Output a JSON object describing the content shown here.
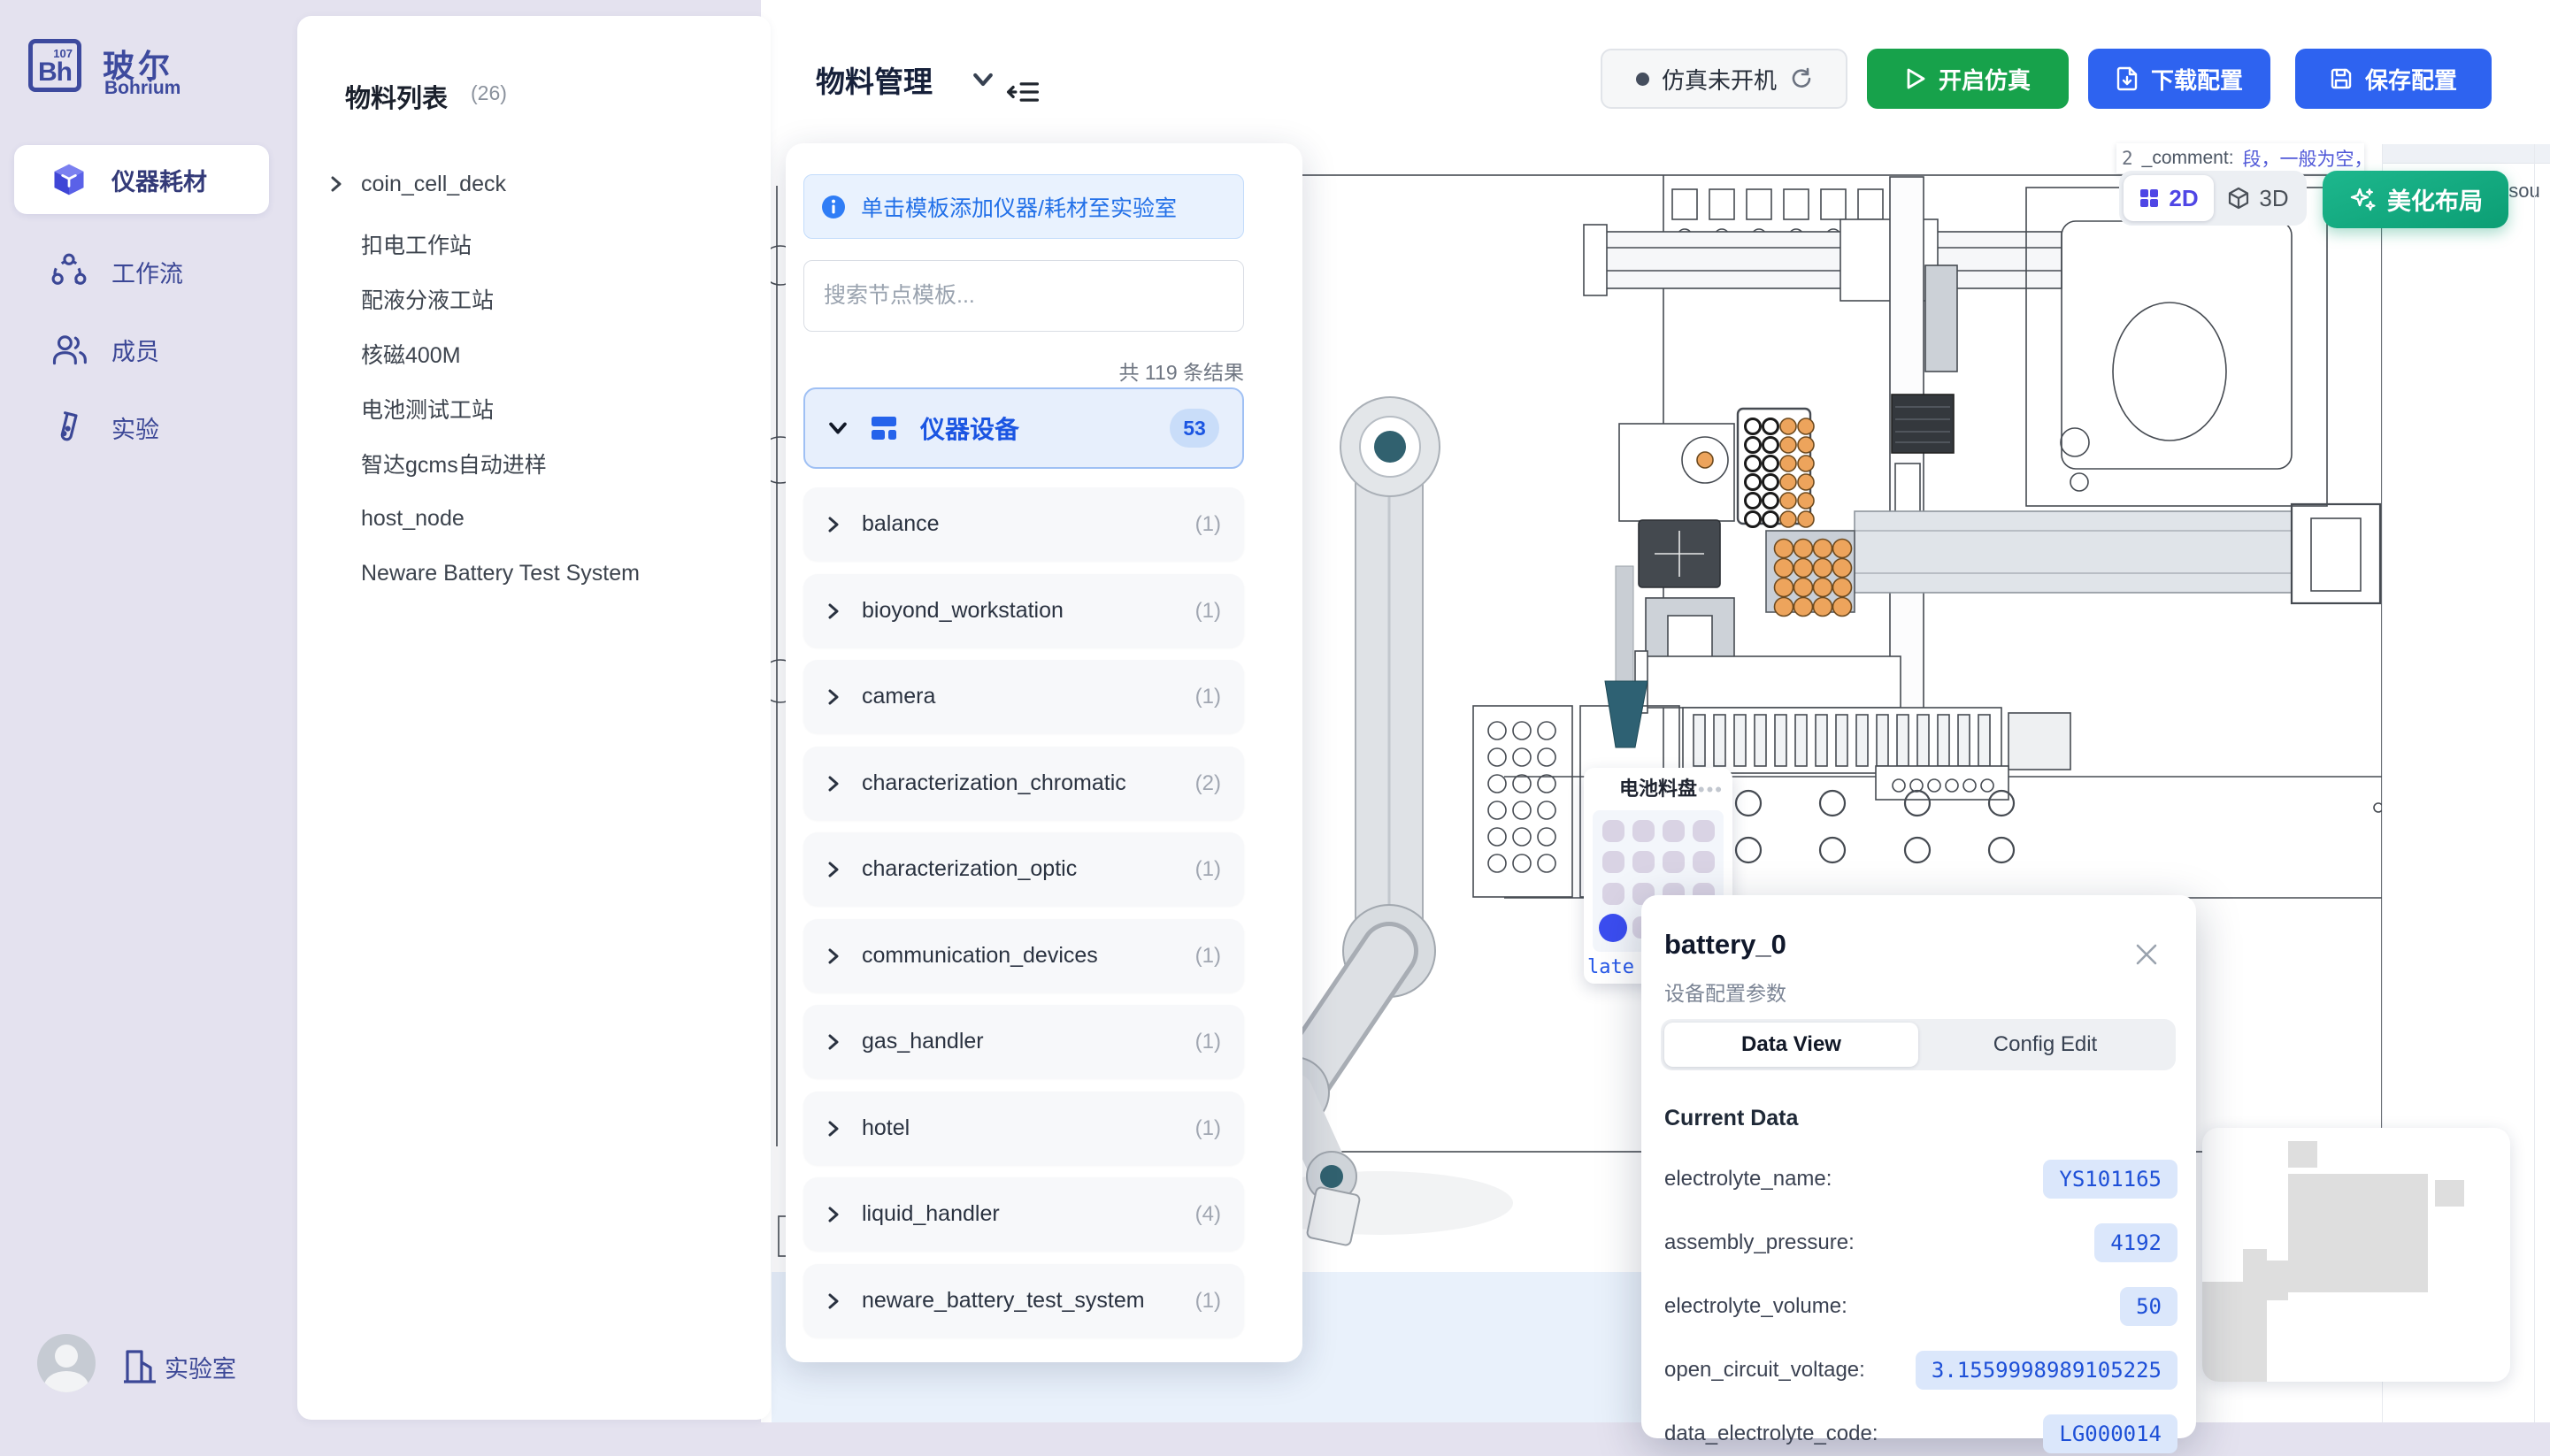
{
  "sidebar": {
    "logo": {
      "initials": "Bh",
      "number": "107",
      "title_zh": "玻尔",
      "title_en": "Bohrium"
    },
    "items": [
      {
        "label": "仪器耗材"
      },
      {
        "label": "工作流"
      },
      {
        "label": "成员"
      },
      {
        "label": "实验"
      }
    ],
    "footer": {
      "label": "实验室"
    }
  },
  "materials": {
    "title": "物料列表",
    "count": "(26)",
    "tree_item": "coin_cell_deck",
    "items": [
      {
        "label": "扣电工作站"
      },
      {
        "label": "配液分液工站"
      },
      {
        "label": "核磁400M"
      },
      {
        "label": "电池测试工站"
      },
      {
        "label": "智达gcms自动进样"
      },
      {
        "label": "host_node"
      },
      {
        "label": "Neware Battery Test System"
      }
    ]
  },
  "header": {
    "title": "物料管理",
    "status_label": "仿真未开机",
    "start_label": "开启仿真",
    "download_label": "下载配置",
    "save_label": "保存配置"
  },
  "palette": {
    "banner": "单击模板添加仪器/耗材至实验室",
    "search_placeholder": "搜索节点模板...",
    "result_count": "共 119 条结果",
    "category": {
      "label": "仪器设备",
      "badge": "53"
    },
    "items": [
      {
        "name": "balance",
        "count": "(1)"
      },
      {
        "name": "bioyond_workstation",
        "count": "(1)"
      },
      {
        "name": "camera",
        "count": "(1)"
      },
      {
        "name": "characterization_chromatic",
        "count": "(2)"
      },
      {
        "name": "characterization_optic",
        "count": "(1)"
      },
      {
        "name": "communication_devices",
        "count": "(1)"
      },
      {
        "name": "gas_handler",
        "count": "(1)"
      },
      {
        "name": "hotel",
        "count": "(1)"
      },
      {
        "name": "liquid_handler",
        "count": "(4)"
      },
      {
        "name": "neware_battery_test_system",
        "count": "(1)"
      }
    ]
  },
  "canvas": {
    "tooltip": {
      "prefix": "2",
      "key": "_comment:",
      "value": "段，一般为空，stat",
      "value2": "此固定"
    },
    "side_fragment": "esou",
    "toggle": {
      "d2": "2D",
      "d3": "3D"
    },
    "beautify_label": "美化布局",
    "tray": {
      "title": "电池料盘",
      "menu": "•••",
      "plate_fragment": "late"
    }
  },
  "popup": {
    "title": "battery_0",
    "subtitle": "设备配置参数",
    "tabs": [
      {
        "label": "Data View"
      },
      {
        "label": "Config Edit"
      }
    ],
    "section": "Current Data",
    "rows": [
      {
        "label": "electrolyte_name:",
        "value": "YS101165"
      },
      {
        "label": "assembly_pressure:",
        "value": "4192"
      },
      {
        "label": "electrolyte_volume:",
        "value": "50"
      },
      {
        "label": "open_circuit_voltage:",
        "value": "3.1559998989105225"
      },
      {
        "label": "data_electrolyte_code:",
        "value": "LG000014"
      }
    ]
  }
}
